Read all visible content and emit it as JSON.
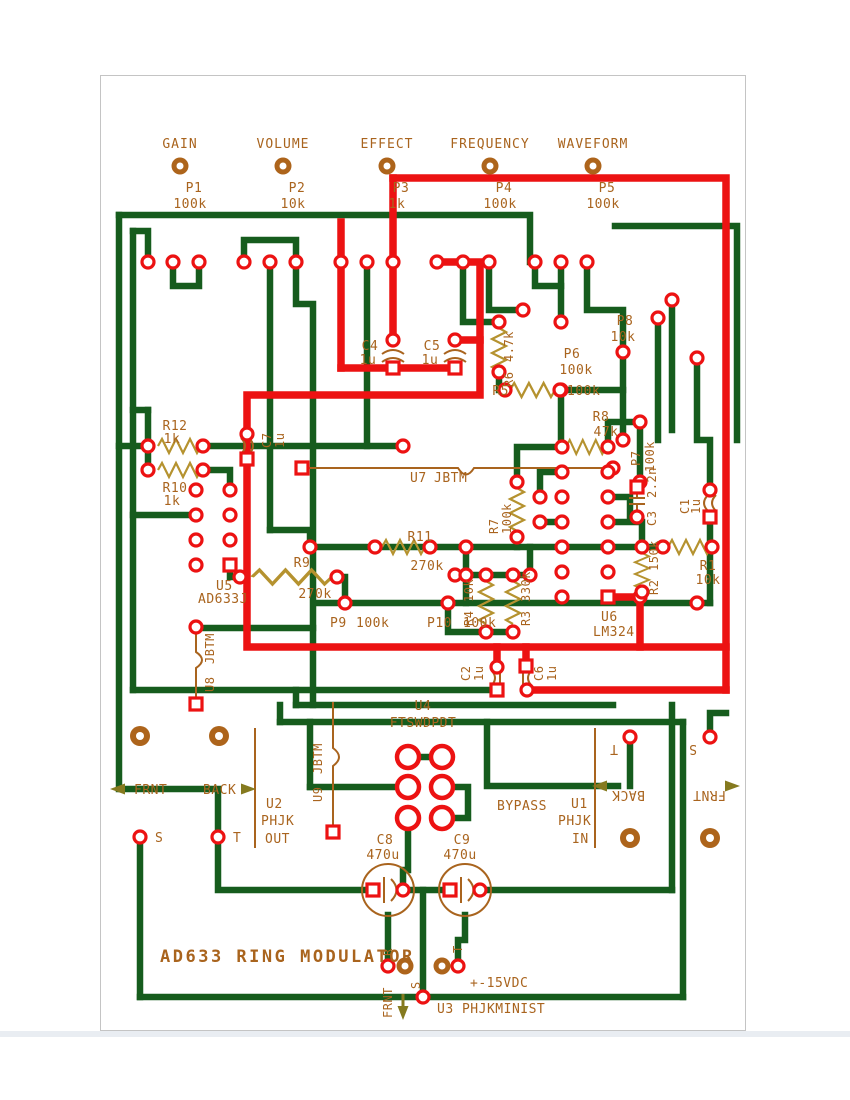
{
  "title": "AD633 RING MODULATOR",
  "colors": {
    "trace_green": "#165c1d",
    "trace_red": "#ec1212",
    "silk_brown": "#a9641e",
    "resistor_gold": "#b5922f",
    "pad_red": "#ec1212"
  },
  "pots": [
    {
      "control": "GAIN",
      "ref": "P1",
      "value": "100k"
    },
    {
      "control": "VOLUME",
      "ref": "P2",
      "value": "10k"
    },
    {
      "control": "EFFECT",
      "ref": "P3",
      "value": "1k"
    },
    {
      "control": "FREQUENCY",
      "ref": "P4",
      "value": "100k"
    },
    {
      "control": "WAVEFORM",
      "ref": "P5",
      "value": "100k"
    }
  ],
  "resistors": {
    "r1": {
      "ref": "R1",
      "value": "10k"
    },
    "r2": {
      "ref": "R2",
      "value": "150k"
    },
    "r3": {
      "ref": "R3",
      "value": "330k"
    },
    "r4": {
      "ref": "R4",
      "value": "10k"
    },
    "r5": {
      "ref": "R5",
      "value": "100k"
    },
    "r6": {
      "ref": "R6",
      "value": "4.7k"
    },
    "r7": {
      "ref": "R7",
      "value": "100k"
    },
    "r8": {
      "ref": "R8",
      "value": "47k"
    },
    "r9": {
      "ref": "R9",
      "value": "270k"
    },
    "r10": {
      "ref": "R10",
      "value": "1k"
    },
    "r11": {
      "ref": "R11",
      "value": "270k"
    },
    "r12": {
      "ref": "R12",
      "value": "1k"
    }
  },
  "trimmers": {
    "p6": {
      "ref": "P6",
      "value": "100k"
    },
    "p7": {
      "ref": "P7",
      "value": "100k"
    },
    "p8": {
      "ref": "P8",
      "value": "10k"
    },
    "p9": {
      "ref": "P9",
      "value": "100k"
    },
    "p10": {
      "ref": "P10",
      "value": "100k"
    }
  },
  "capacitors": {
    "c1": {
      "ref": "C1",
      "value": "1u"
    },
    "c2": {
      "ref": "C2",
      "value": "1u"
    },
    "c3": {
      "ref": "C3",
      "value": "2.2n"
    },
    "c4": {
      "ref": "C4",
      "value": "1u"
    },
    "c5": {
      "ref": "C5",
      "value": "1u"
    },
    "c6": {
      "ref": "C6",
      "value": "1u"
    },
    "c7": {
      "ref": "C7",
      "value": "1u"
    },
    "c8": {
      "ref": "C8",
      "value": "470u"
    },
    "c9": {
      "ref": "C9",
      "value": "470u"
    }
  },
  "ics": {
    "u5": {
      "ref": "U5",
      "part": "AD633J"
    },
    "u6": {
      "ref": "U6",
      "part": "LM324"
    }
  },
  "jumpers": {
    "u7": {
      "ref": "U7",
      "part": "JBTM"
    },
    "u8": {
      "ref": "U8",
      "part": "JBTM"
    },
    "u9": {
      "ref": "U9",
      "part": "JBTM"
    }
  },
  "footswitch": {
    "ref": "U4",
    "part": "FTSWDPDT"
  },
  "jacks": {
    "u2": {
      "ref": "U2",
      "line1": "PHJK",
      "line2": "OUT"
    },
    "u1": {
      "ref": "U1",
      "line1": "PHJK",
      "line2": "IN"
    }
  },
  "connector": {
    "label": "U3 PHJKMINIST"
  },
  "power_label": "+-15VDC",
  "nav": {
    "frnt": "FRNT",
    "back": "BACK",
    "bypass": "BYPASS"
  },
  "pins": {
    "tip": "T",
    "sleeve": "S",
    "ring": "R"
  }
}
